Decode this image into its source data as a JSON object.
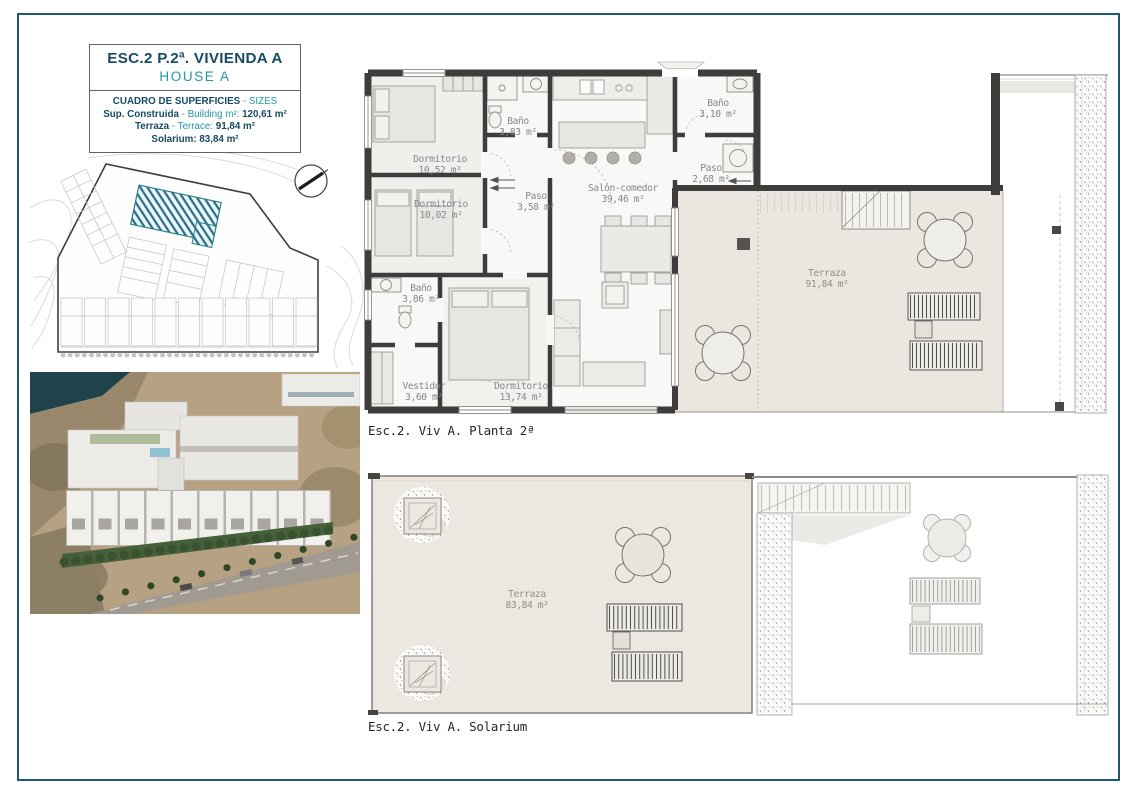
{
  "colors": {
    "page_border": "#1d5970",
    "title_navy": "#174a63",
    "title_teal": "#2596a8",
    "plan_wall": "#3e3d3b",
    "terrace_fill": "#ebe7e0",
    "site_highlight_hatch": "#2a7d92",
    "room_label": "#84878c",
    "area_label_gray": "#908d87"
  },
  "title_block": {
    "title": "ESC.2 P.2ª. VIVIENDA A",
    "subtitle": "HOUSE A",
    "table_header": "CUADRO DE SUPERFICIES",
    "table_header_en": "- SIZES",
    "rows": [
      {
        "label": "Sup. Construida",
        "label_en": "- Building m²:",
        "value": "120,61 m²"
      },
      {
        "label": "Terraza",
        "label_en": "- Terrace:",
        "value": "91,84 m²"
      },
      {
        "label": "Solarium:",
        "label_en": "",
        "value": "83,84 m²"
      }
    ]
  },
  "floor_plan": {
    "caption": "Esc.2. Viv A. Planta 2ª",
    "rooms": {
      "dormitorio_1": {
        "name": "Dormitorio",
        "area": "10,52 m²"
      },
      "bano_1": {
        "name": "Baño",
        "area": "3,83 m²"
      },
      "dormitorio_2": {
        "name": "Dormitorio",
        "area": "10,02 m²"
      },
      "paso_1": {
        "name": "Paso",
        "area": "3,58 m²"
      },
      "salon": {
        "name": "Salón-comedor",
        "area": "39,46 m²"
      },
      "bano_2": {
        "name": "Baño",
        "area": "3,10 m²"
      },
      "paso_2": {
        "name": "Paso",
        "area": "2,68 m²"
      },
      "bano_3": {
        "name": "Baño",
        "area": "3,86 m²"
      },
      "vestidor": {
        "name": "Vestidor",
        "area": "3,60 m²"
      },
      "dormitorio_3": {
        "name": "Dormitorio",
        "area": "13,74 m²"
      },
      "terraza": {
        "name": "Terraza",
        "area": "91,84 m²"
      }
    }
  },
  "solarium_plan": {
    "caption": "Esc.2. Viv A. Solarium",
    "rooms": {
      "terraza": {
        "name": "Terraza",
        "area": "83,84 m²"
      }
    }
  }
}
